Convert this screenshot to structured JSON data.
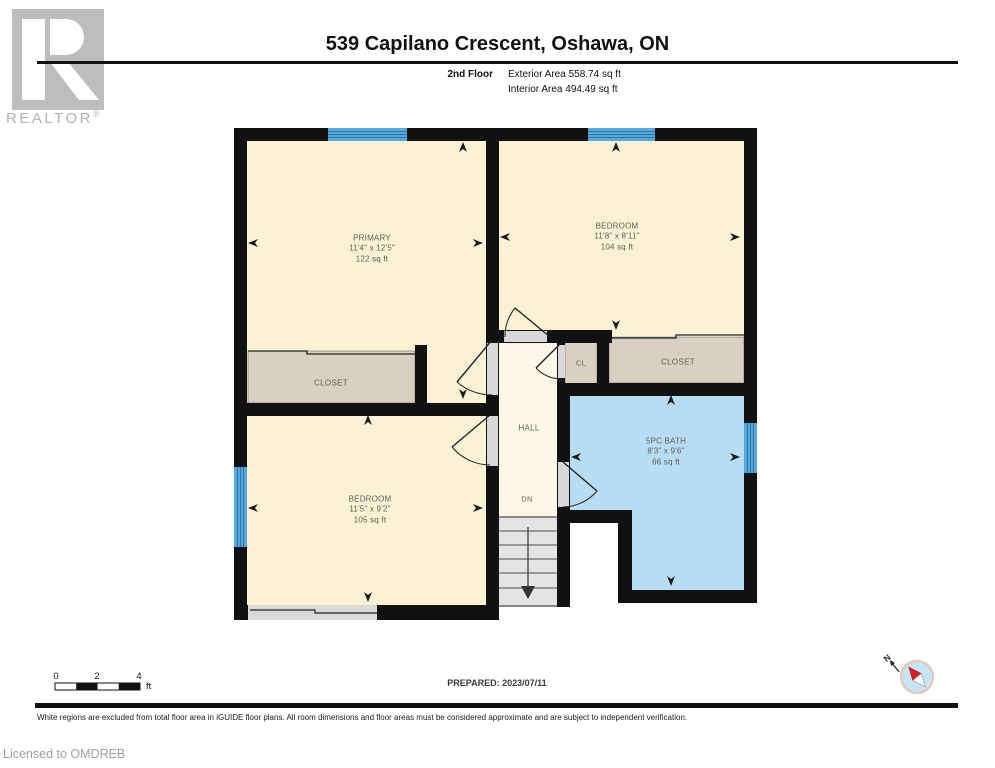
{
  "header": {
    "logo": {
      "realtor_label": "REALTOR",
      "registered": "®"
    },
    "title": "539 Capilano Crescent, Oshawa, ON",
    "floor_label": "2nd Floor",
    "exterior_area": "Exterior Area 558.74 sq ft",
    "interior_area": "Interior Area 494.49 sq ft"
  },
  "rooms": [
    {
      "name": "PRIMARY",
      "dims": "11'4\" x 12'5\"",
      "area": "122 sq ft"
    },
    {
      "name": "BEDROOM",
      "dims": "11'8\" x 8'11\"",
      "area": "104 sq ft"
    },
    {
      "name": "BEDROOM",
      "dims": "11'5\" x 9'2\"",
      "area": "105 sq ft"
    },
    {
      "name": "5PC BATH",
      "dims": "8'3\" x 9'6\"",
      "area": "66 sq ft"
    },
    {
      "name": "CLOSET"
    },
    {
      "name": "CL"
    },
    {
      "name": "CLOSET"
    },
    {
      "name": "HALL"
    },
    {
      "name": "DN"
    }
  ],
  "scale_bar": {
    "zero": "0",
    "two": "2",
    "four": "4",
    "unit": "ft"
  },
  "footer": {
    "prepared": "PREPARED: 2023/07/11",
    "disclaimer": "White regions are excluded from total floor area in iGUIDE floor plans. All room dimensions and floor areas must be considered approximate and are subject to independent verification.",
    "license": "Licensed to OMDREB",
    "compass_n": "N"
  },
  "colors": {
    "wall": "#111111",
    "room_fill": "#FBF1D4",
    "hall_fill": "#FCF7E8",
    "closet_fill": "#D8D1C3",
    "bath_fill": "#B7DDF5",
    "window_blue": "#57A8DB",
    "window_stripe": "#2E74AC",
    "stair_fill": "#E4E4E4",
    "opening_gray": "#D8D8D8",
    "logo_gray": "#BDBDBD"
  }
}
